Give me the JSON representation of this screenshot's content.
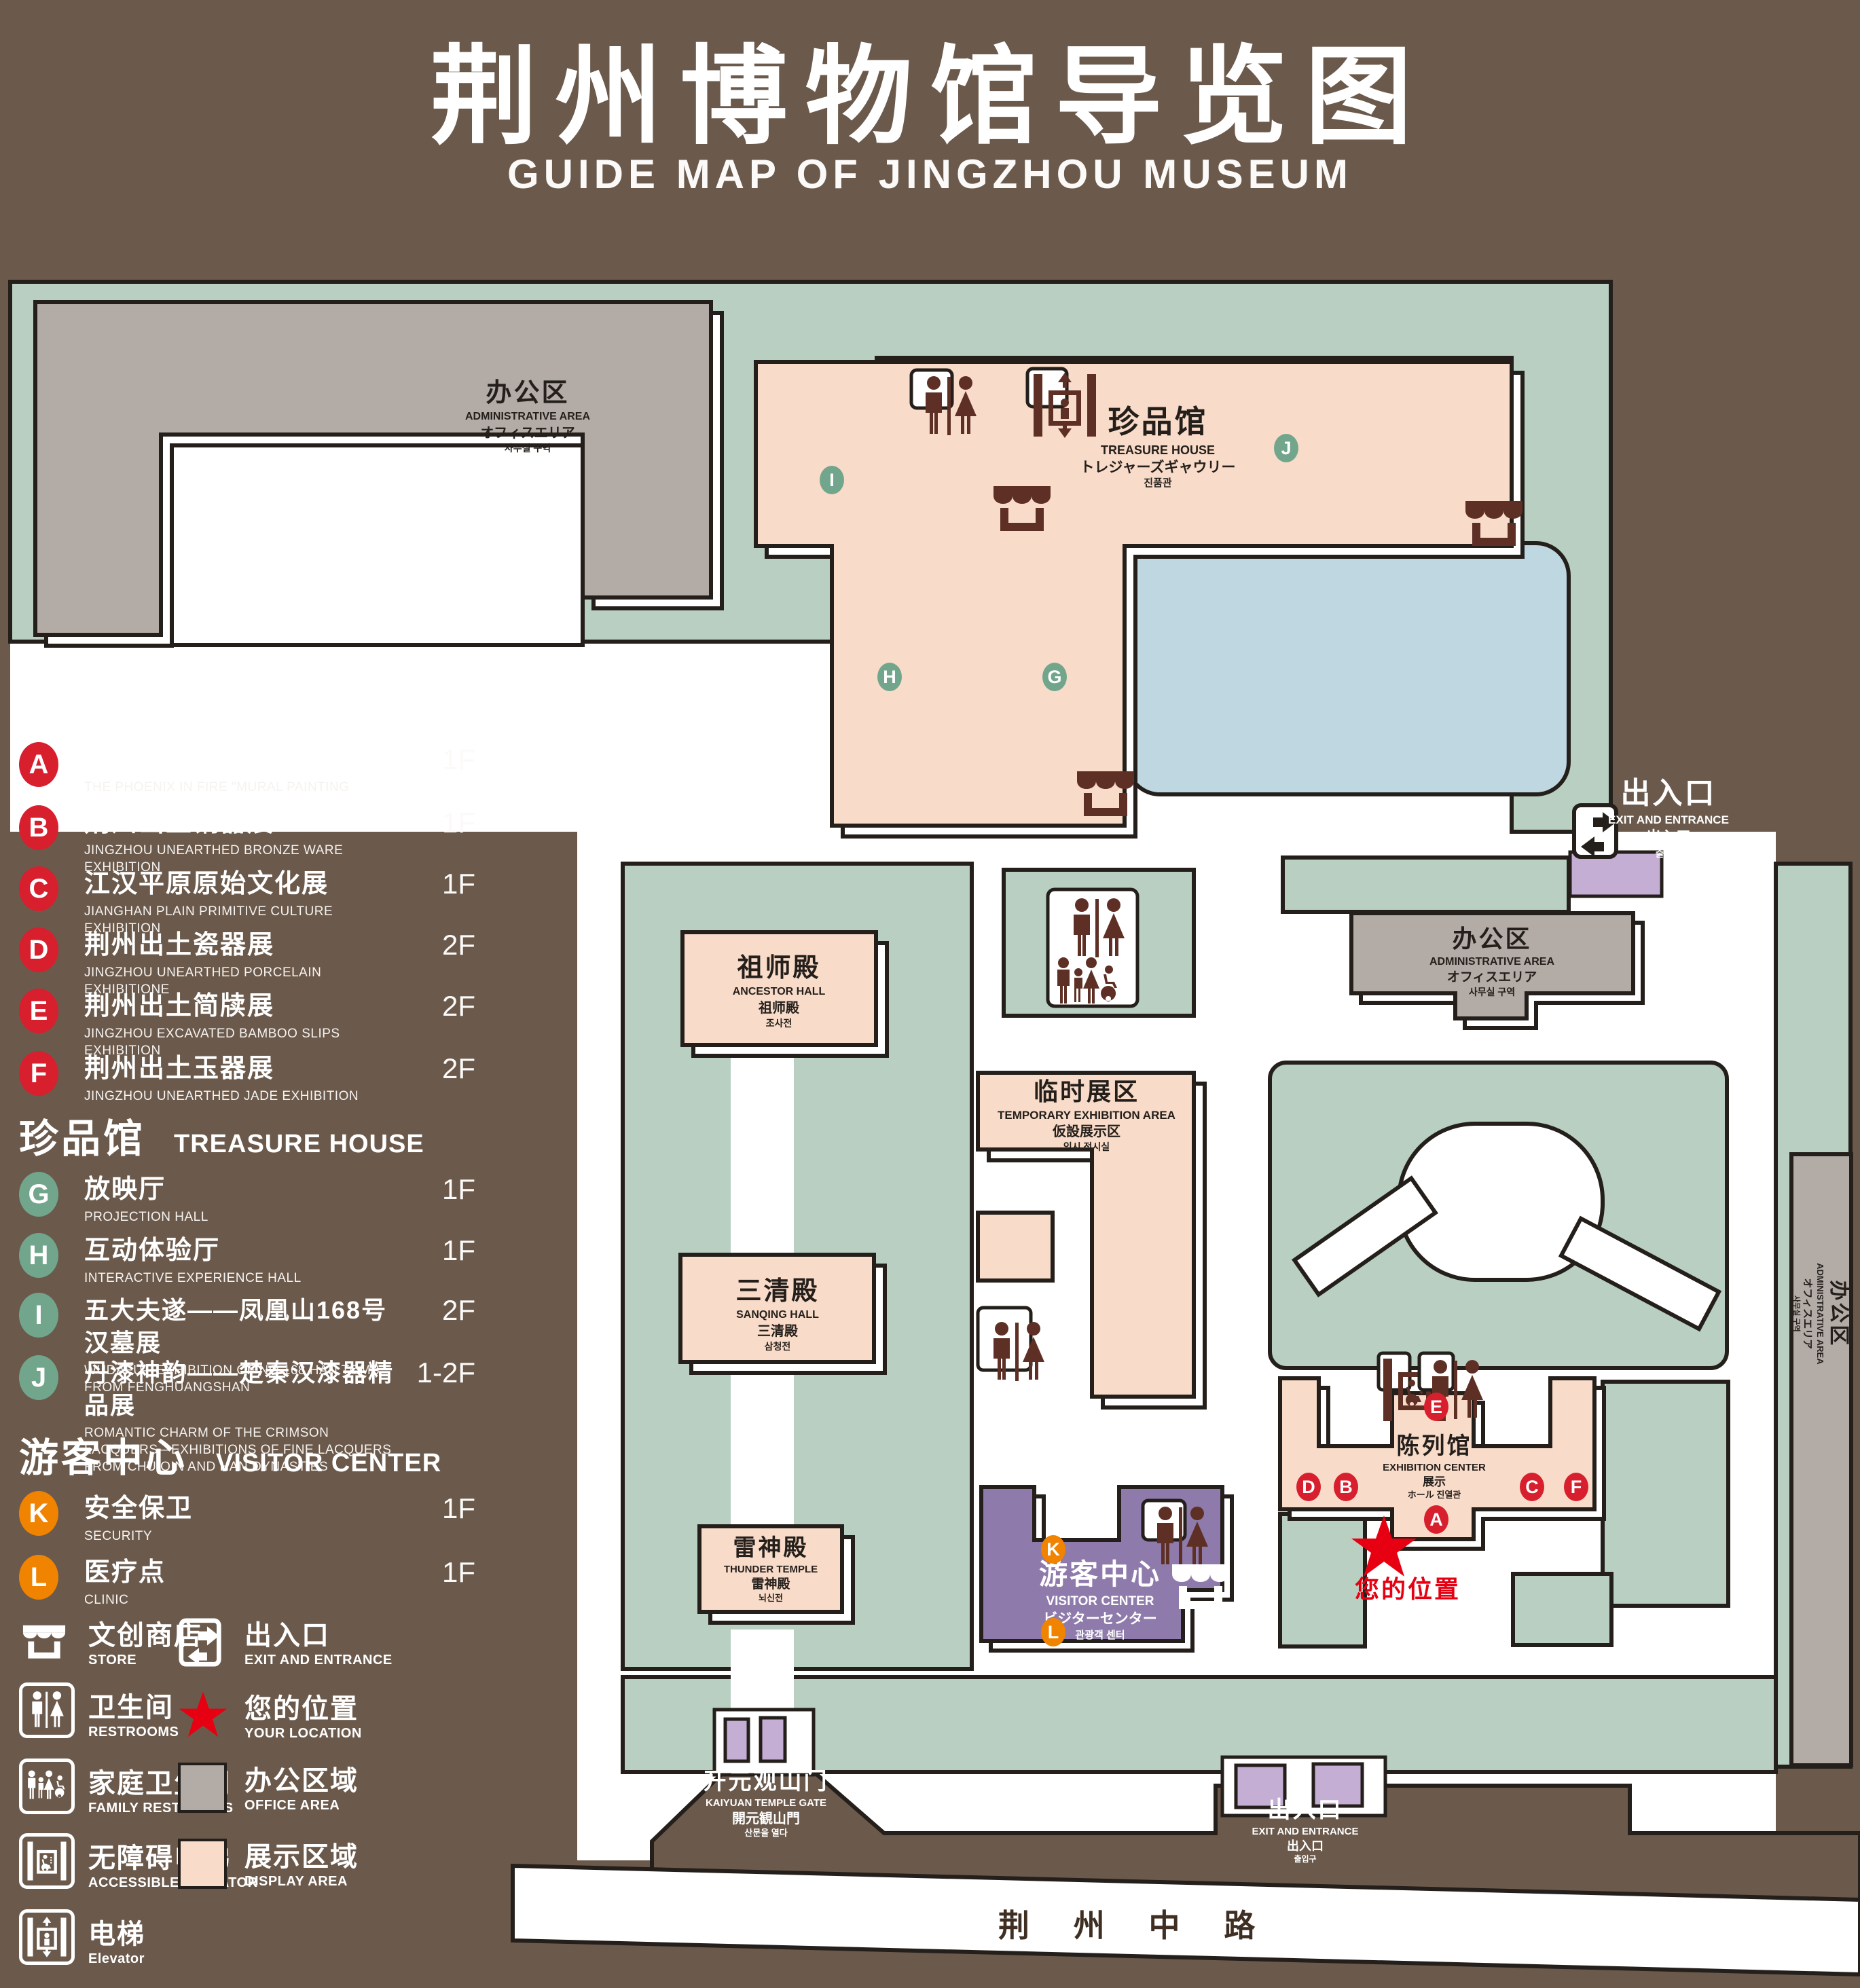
{
  "title": {
    "zh": "荆州博物馆导览图",
    "en": "GUIDE MAP OF JINGZHOU MUSEUM"
  },
  "legend": {
    "sections": [
      {
        "zh": "陈列馆",
        "en": "EXHIBITION CENTER",
        "items": [
          {
            "letter": "A",
            "zh": "《火中的凤凰》壁画",
            "en": "THE PHOENIX IN FIRE \"MURAL PAINTING",
            "floor": "1F"
          },
          {
            "letter": "B",
            "zh": "荆州出土铜器展",
            "en": "JINGZHOU UNEARTHED BRONZE WARE EXHIBITION",
            "floor": "1F"
          },
          {
            "letter": "C",
            "zh": "江汉平原原始文化展",
            "en": "JIANGHAN PLAIN PRIMITIVE CULTURE EXHIBITION",
            "floor": "1F"
          },
          {
            "letter": "D",
            "zh": "荆州出土瓷器展",
            "en": "JINGZHOU UNEARTHED PORCELAIN EXHIBITIONE",
            "floor": "2F"
          },
          {
            "letter": "E",
            "zh": "荆州出土简牍展",
            "en": "JINGZHOU EXCAVATED BAMBOO SLIPS EXHIBITION",
            "floor": "2F"
          },
          {
            "letter": "F",
            "zh": "荆州出土玉器展",
            "en": "JINGZHOU UNEARTHED JADE EXHIBITION",
            "floor": "2F"
          }
        ]
      },
      {
        "zh": "珍品馆",
        "en": "TREASURE HOUSE",
        "items": [
          {
            "letter": "G",
            "zh": "放映厅",
            "en": "PROJECTION HALL",
            "floor": "1F"
          },
          {
            "letter": "H",
            "zh": "互动体验厅",
            "en": "INTERACTIVE EXPERIENCE HALL",
            "floor": "1F"
          },
          {
            "letter": "I",
            "zh": "五大夫遂——凤凰山168号汉墓展",
            "en": "WUDAFU—EXHIBITION OF NO.168 HAN TOMB FROM FENGHUANGSHAN",
            "floor": "2F"
          },
          {
            "letter": "J",
            "zh": "丹漆神韵——楚秦汉漆器精品展",
            "en": "ROMANTIC CHARM OF THE CRIMSON LACQUERS—EXHIBITIONS OF FINE LACQUERS FROM CHU,QIN AND HAN DYNASTIES",
            "floor": "1-2F"
          }
        ]
      },
      {
        "zh": "游客中心",
        "en": "VISITOR CENTER",
        "items": [
          {
            "letter": "K",
            "zh": "安全保卫",
            "en": "SECURITY",
            "floor": "1F"
          },
          {
            "letter": "L",
            "zh": "医疗点",
            "en": "CLINIC",
            "floor": "1F"
          }
        ]
      }
    ],
    "icons": [
      {
        "zh": "文创商店",
        "en": "STORE"
      },
      {
        "zh": "出入口",
        "en": "EXIT AND ENTRANCE"
      },
      {
        "zh": "卫生间",
        "en": "RESTROOMS"
      },
      {
        "zh": "您的位置",
        "en": "YOUR LOCATION"
      },
      {
        "zh": "家庭卫生间",
        "en": "FAMILY RESTROOMS"
      },
      {
        "zh": "办公区域",
        "en": "OFFICE AREA"
      },
      {
        "zh": "无障碍电梯",
        "en": "ACCESSIBLE ELEVATOR"
      },
      {
        "zh": "展示区域",
        "en": "DISPLAY AREA"
      },
      {
        "zh": "电梯",
        "en": "Elevator"
      }
    ]
  },
  "map": {
    "admin": {
      "zh": "办公区",
      "en": "ADMINISTRATIVE AREA",
      "jp": "オフィスエリア",
      "kr": "사무실 구역"
    },
    "treasure": {
      "zh": "珍品馆",
      "en": "TREASURE HOUSE",
      "jp": "トレジャーズギャウリー",
      "kr": "진품관"
    },
    "ancestor": {
      "zh": "祖师殿",
      "en": "ANCESTOR HALL",
      "jp": "祖师殿",
      "kr": "조사전"
    },
    "temporary": {
      "zh": "临时展区",
      "en": "TEMPORARY EXHIBITION AREA",
      "jp": "仮設展示区",
      "kr": "임시 전시실"
    },
    "sanqing": {
      "zh": "三清殿",
      "en": "SANQING HALL",
      "jp": "三清殿",
      "kr": "삼청전"
    },
    "thunder": {
      "zh": "雷神殿",
      "en": "THUNDER TEMPLE",
      "jp": "雷神殿",
      "kr": "뇌신전"
    },
    "exhibition": {
      "zh": "陈列馆",
      "en": "EXHIBITION CENTER",
      "jp": "展示",
      "kr": "ホール 진열관"
    },
    "visitor": {
      "zh": "游客中心",
      "en": "VISITOR CENTER",
      "jp": "ビジターセンター",
      "kr": "관광객 센터"
    },
    "gate": {
      "zh": "开元观山门",
      "en": "KAIYUAN TEMPLE GATE",
      "jp": "開元観山門",
      "kr": "산문을 열다"
    },
    "exit": {
      "zh": "出入口",
      "en": "EXIT AND ENTRANCE",
      "jp": "出入口",
      "kr": "출입구"
    },
    "road": {
      "zh": "荆 州 中 路"
    },
    "your_location": {
      "zh": "您的位置"
    },
    "markers": {
      "i": "I",
      "g": "G",
      "h": "H",
      "j": "J",
      "e": "E",
      "d": "D",
      "b": "B",
      "c": "C",
      "f": "F",
      "a": "A",
      "k": "K",
      "l": "L"
    }
  },
  "colors": {
    "background": "#6b5a4c",
    "courtyard_green": "#b9cfc2",
    "display_pink": "#f8dbc9",
    "office_gray": "#b2aba6",
    "visitor_purple": "#8e7bab",
    "pond_blue": "#bed7e1",
    "gate_lavender": "#c5aed3",
    "badge_red": "#d71f2e",
    "badge_green": "#72a68c",
    "badge_orange": "#f08300",
    "location_red": "#e60012",
    "outline": "#241f1b"
  }
}
